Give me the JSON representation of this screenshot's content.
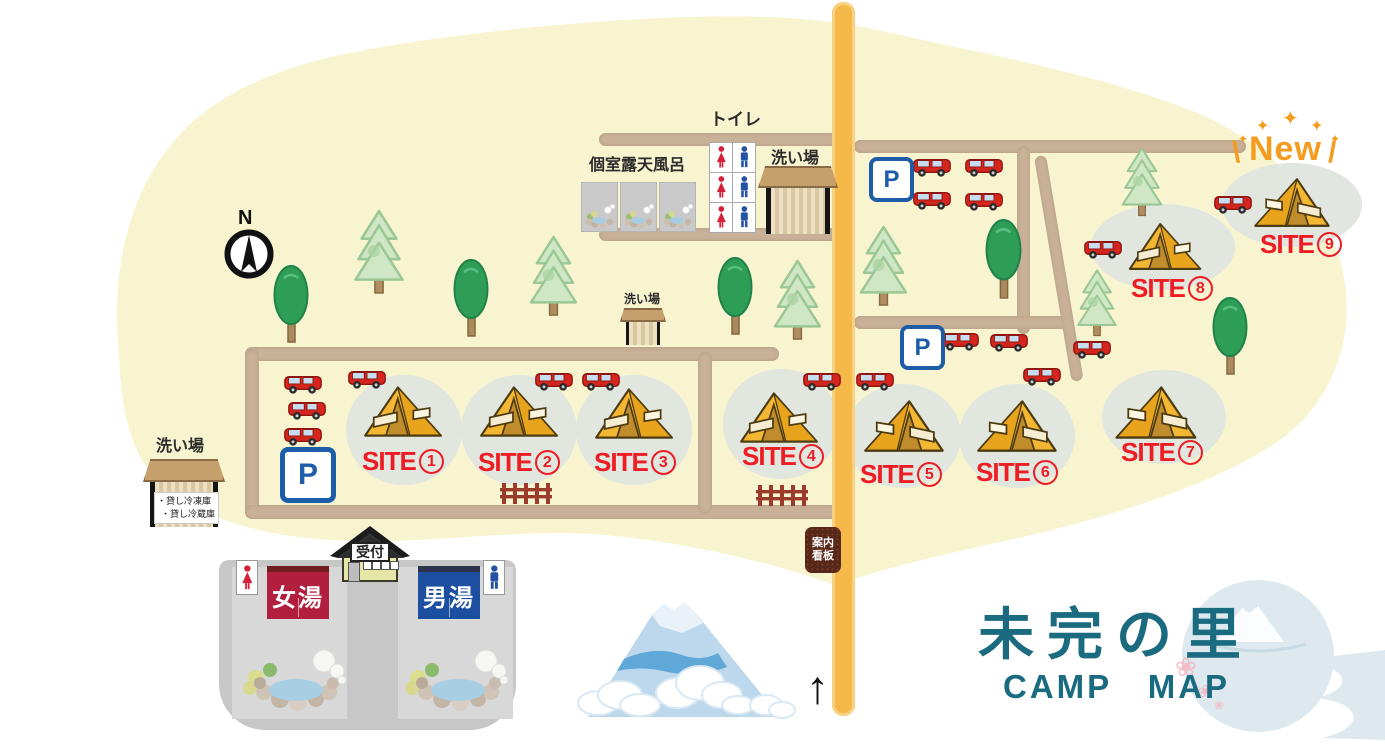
{
  "map_title": {
    "main": "未完の里",
    "sub": "CAMP MAP"
  },
  "compass_label": "N",
  "new_badge": {
    "backslash": "\\",
    "label": "New",
    "slash": "/",
    "sparkle": "✦"
  },
  "labels": {
    "toilet": "トイレ",
    "private_open_air_bath": "個室露天風呂",
    "wash_area": "洗い場",
    "parking": "P",
    "reception": "受付",
    "womens_bath": "女湯",
    "mens_bath": "男湯",
    "info_sign_line1": "案内",
    "info_sign_line2": "看板",
    "rental_freezer": "・貸し冷凍庫",
    "rental_fridge": "・貸し冷蔵庫",
    "entrance_arrow": "↑"
  },
  "sites": [
    {
      "prefix": "SITE",
      "number": "1"
    },
    {
      "prefix": "SITE",
      "number": "2"
    },
    {
      "prefix": "SITE",
      "number": "3"
    },
    {
      "prefix": "SITE",
      "number": "4"
    },
    {
      "prefix": "SITE",
      "number": "5"
    },
    {
      "prefix": "SITE",
      "number": "6"
    },
    {
      "prefix": "SITE",
      "number": "7"
    },
    {
      "prefix": "SITE",
      "number": "8"
    },
    {
      "prefix": "SITE",
      "number": "9"
    }
  ],
  "icons": {
    "sakura": "❀",
    "sparkle": "✦"
  },
  "colors": {
    "ground_cream": "#f8f4d0",
    "path_tan": "#c9b199",
    "main_road_orange": "#f5b94a",
    "site_label_red": "#ee1c24",
    "parking_blue": "#1c5ca8",
    "title_teal": "#1a6b80",
    "new_orange": "#f59b1e",
    "womens_bath_red": "#b21e3d",
    "mens_bath_blue": "#1c4f9f",
    "tent_yellow": "#f4b733",
    "car_red": "#d5261e"
  }
}
